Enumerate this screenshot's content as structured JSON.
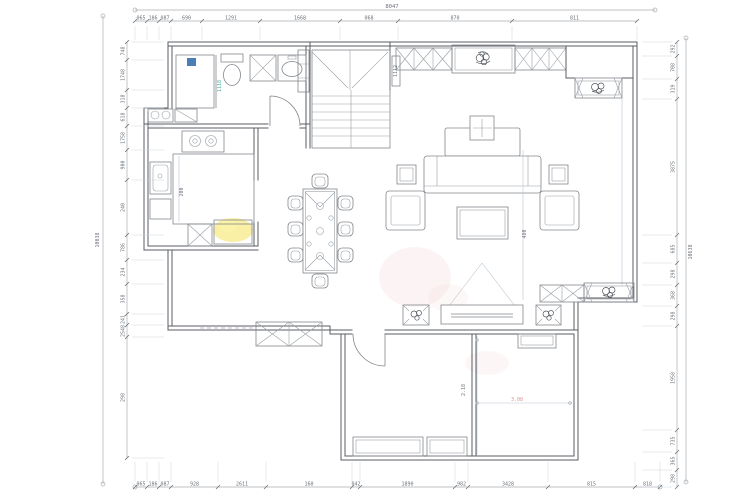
{
  "drawing": {
    "type": "residential-floor-plan",
    "title": "",
    "background": "#ffffff"
  },
  "colors": {
    "wall_line": "#585d64",
    "furniture_line": "#82878d",
    "dimension_line": "#a7acb2",
    "dimension_text": "#6d7278",
    "grid_hatch": "#c3c8cd",
    "accent_teal": "#3fae9f",
    "accent_blue": "#4a7fb5",
    "highlight_yellow": "#f7ec8e",
    "watermark_pink": "#e8a7a7",
    "red_dim_text": "#c97b74"
  },
  "dimensions": {
    "top": {
      "overall": "8047",
      "segments": [
        "065",
        "186",
        "087",
        "690",
        "1291",
        "1668",
        "068",
        "870",
        "811"
      ]
    },
    "bottom": {
      "segments": [
        "065",
        "186",
        "087",
        "928",
        "2611",
        "160",
        "042",
        "1890",
        "982",
        "3428",
        "815",
        "818"
      ]
    },
    "left": {
      "overall": "10038",
      "segments": [
        "748",
        "1748",
        "318",
        "618",
        "1758",
        "900",
        "240",
        "786",
        "234",
        "358",
        "241",
        "2548",
        "298"
      ]
    },
    "right": {
      "overall": "10638",
      "segments": [
        "292",
        "708",
        "319",
        "3875",
        "685",
        "298",
        "368",
        "298",
        "1958",
        "735",
        "365",
        "298"
      ]
    },
    "interior": {
      "kitchen_depth": "200",
      "shower_screen": "1118",
      "stair_well": "1112",
      "living_width": "480",
      "bedroom_height": "2.18",
      "bedroom_width": "3.08"
    }
  }
}
